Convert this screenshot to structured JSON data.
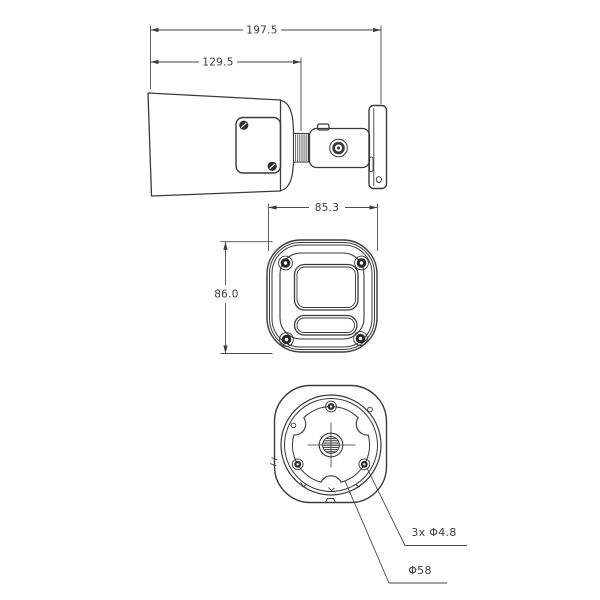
{
  "background": "#ffffff",
  "drawing": {
    "line_color": "#3a3a3a",
    "text_color": "#3d3d3d",
    "type": "camera-dimension-drawing"
  },
  "dimensions": {
    "overall_length": "197.5",
    "body_length": "129.5",
    "front_width": "85.3",
    "front_height": "86.0"
  },
  "callouts": {
    "mount_holes": "3x Φ4.8",
    "mount_circle_diameter": "Φ58"
  }
}
